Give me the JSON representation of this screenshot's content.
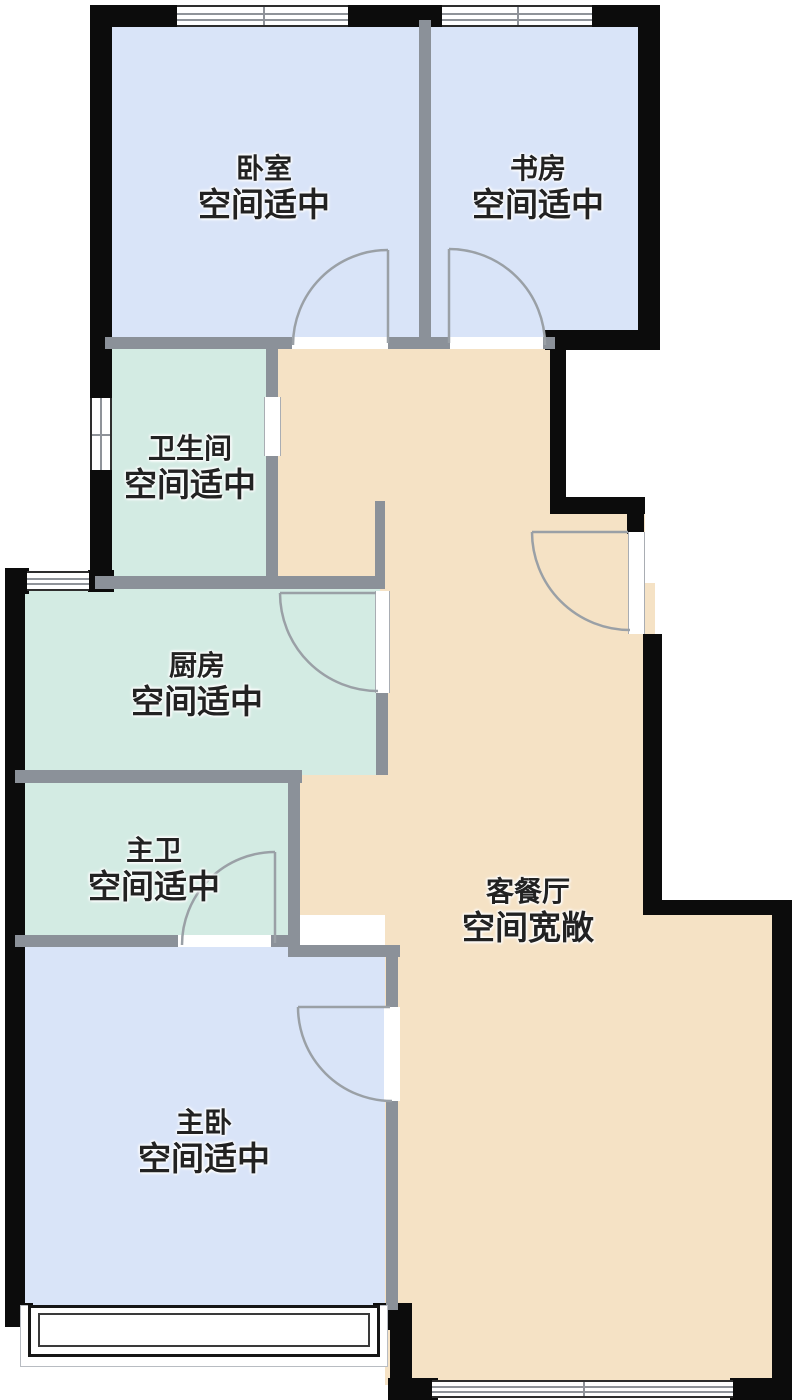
{
  "plan": {
    "type": "apartment-floor-plan",
    "rooms": [
      {
        "id": "bedroom",
        "name": "卧室",
        "desc": "空间适中",
        "fill": "#d9e4f8"
      },
      {
        "id": "study",
        "name": "书房",
        "desc": "空间适中",
        "fill": "#d9e4f8"
      },
      {
        "id": "bathroom",
        "name": "卫生间",
        "desc": "空间适中",
        "fill": "#d3ebe3"
      },
      {
        "id": "kitchen",
        "name": "厨房",
        "desc": "空间适中",
        "fill": "#d3ebe3"
      },
      {
        "id": "master-bath",
        "name": "主卫",
        "desc": "空间适中",
        "fill": "#d3ebe3"
      },
      {
        "id": "living-dining",
        "name": "客餐厅",
        "desc": "空间宽敞",
        "fill": "#f5e2c5"
      },
      {
        "id": "master-bedroom",
        "name": "主卧",
        "desc": "空间适中",
        "fill": "#d9e4f8"
      }
    ],
    "colors": {
      "outer_wall": "#0c0c0c",
      "inner_wall": "#8b9199",
      "door_arc": "#9aa0a6",
      "bedroom_fill": "#d9e4f8",
      "wet_room_fill": "#d3ebe3",
      "living_fill": "#f5e2c5",
      "background": "#ffffff",
      "label_text": "#222222"
    }
  }
}
